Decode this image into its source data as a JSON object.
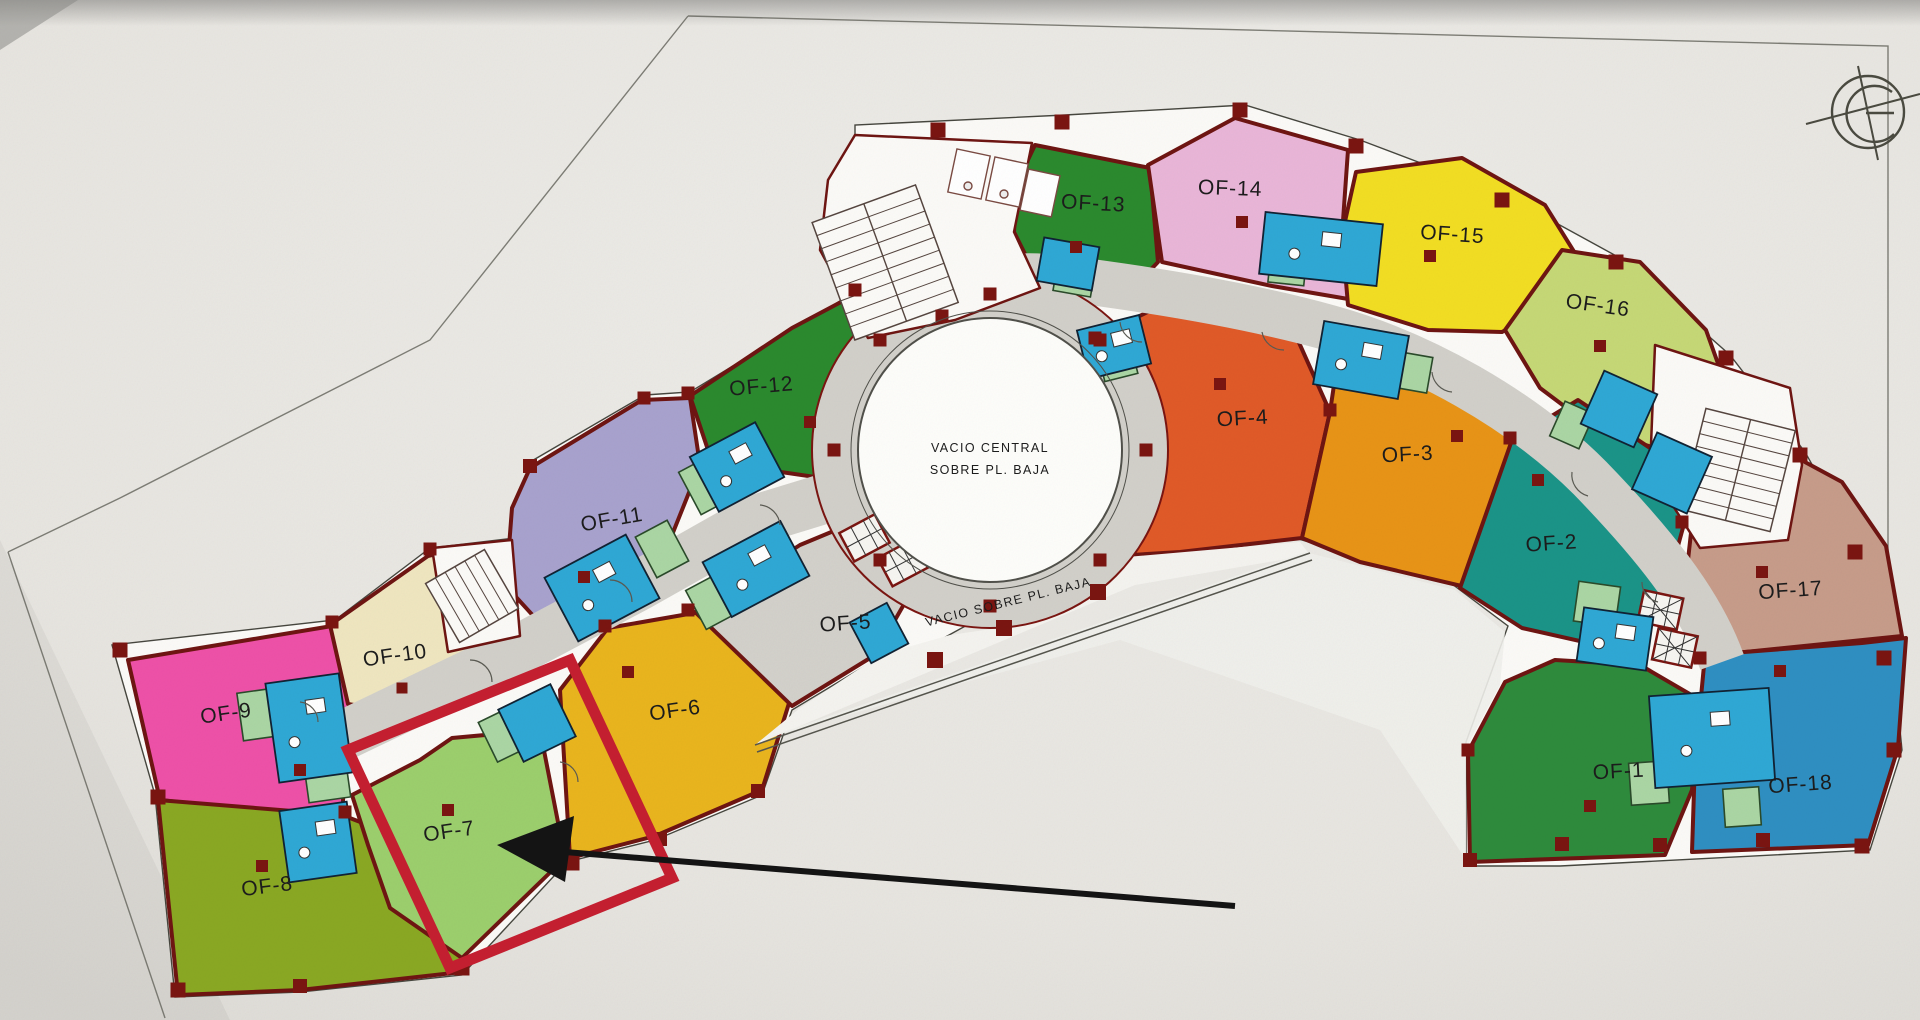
{
  "plan": {
    "central_void_line1": "VACIO CENTRAL",
    "central_void_line2": "SOBRE PL. BAJA",
    "void_note": "VACIO SOBRE PL. BAJA"
  },
  "offices": [
    {
      "id": "OF-1",
      "label": "OF-1",
      "color": "#2e8b3c",
      "x": 1619,
      "y": 778,
      "rot": -3
    },
    {
      "id": "OF-2",
      "label": "OF-2",
      "color": "#1b9488",
      "x": 1552,
      "y": 550,
      "rot": -4
    },
    {
      "id": "OF-3",
      "label": "OF-3",
      "color": "#e89417",
      "x": 1408,
      "y": 461,
      "rot": -3
    },
    {
      "id": "OF-4",
      "label": "OF-4",
      "color": "#e05a28",
      "x": 1243,
      "y": 425,
      "rot": -3
    },
    {
      "id": "OF-5",
      "label": "OF-5",
      "color": "#d3d1cb",
      "x": 846,
      "y": 630,
      "rot": -4
    },
    {
      "id": "OF-6",
      "label": "OF-6",
      "color": "#e9b51e",
      "x": 676,
      "y": 717,
      "rot": -8
    },
    {
      "id": "OF-7",
      "label": "OF-7",
      "color": "#9ccf6d",
      "x": 450,
      "y": 838,
      "rot": -8
    },
    {
      "id": "OF-8",
      "label": "OF-8",
      "color": "#8aa823",
      "x": 268,
      "y": 893,
      "rot": -7
    },
    {
      "id": "OF-9",
      "label": "OF-9",
      "color": "#ee51a8",
      "x": 227,
      "y": 720,
      "rot": -8
    },
    {
      "id": "OF-10",
      "label": "OF-10",
      "color": "#efe6c0",
      "x": 396,
      "y": 662,
      "rot": -8
    },
    {
      "id": "OF-11",
      "label": "OF-11",
      "color": "#a8a2ce",
      "x": 613,
      "y": 526,
      "rot": -10
    },
    {
      "id": "OF-12",
      "label": "OF-12",
      "color": "#2b8a2e",
      "x": 762,
      "y": 393,
      "rot": -5
    },
    {
      "id": "OF-13",
      "label": "OF-13",
      "color": "#2b8a2e",
      "x": 1093,
      "y": 210,
      "rot": 3
    },
    {
      "id": "OF-14",
      "label": "OF-14",
      "color": "#e9b6d8",
      "x": 1230,
      "y": 195,
      "rot": 2
    },
    {
      "id": "OF-15",
      "label": "OF-15",
      "color": "#f2de23",
      "x": 1452,
      "y": 241,
      "rot": 4
    },
    {
      "id": "OF-16",
      "label": "OF-16",
      "color": "#c6d876",
      "x": 1597,
      "y": 312,
      "rot": 8
    },
    {
      "id": "OF-17",
      "label": "OF-17",
      "color": "#c79c8a",
      "x": 1791,
      "y": 597,
      "rot": -4
    },
    {
      "id": "OF-18",
      "label": "OF-18",
      "color": "#2f8fc2",
      "x": 1801,
      "y": 791,
      "rot": -4
    }
  ],
  "annotation": {
    "box_color": "#c51f30",
    "arrow_color": "#141414"
  },
  "palette": {
    "wall": "#6e1512",
    "corridor": "#d2d0ca",
    "bathroom": "#2fa8d5",
    "closet": "#abd6a4",
    "column": "#7a1511",
    "paper": "#e8e6e1",
    "plan_white": "#fbfaf7"
  }
}
